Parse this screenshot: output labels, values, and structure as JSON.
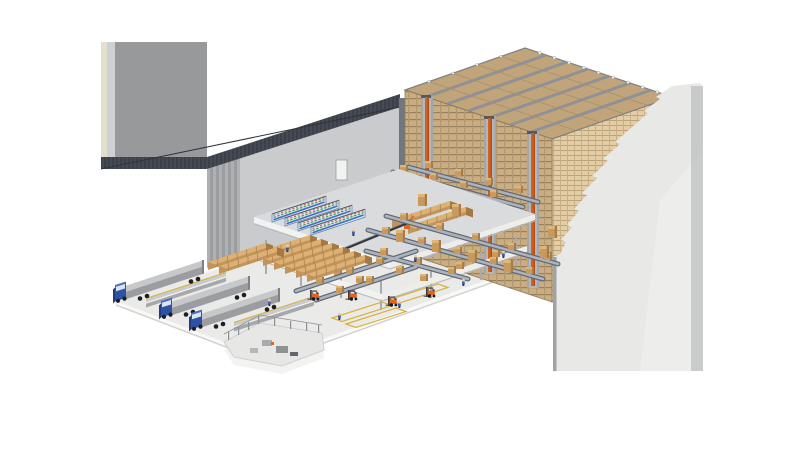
{
  "scene": {
    "description": "Isometric cutaway illustration of an automated warehouse: high-bay AS/RS pallet racking with orange stacker crane masts, multi-level picking mezzanine with bin shelving, conveyor network, floor staging lanes with palletized cardboard boxes, loading docks with trucks, and a fenced machinery enclosure",
    "projection": "isometric",
    "counts": {
      "trucks": 3,
      "stacker_crane_masts": 3,
      "rack_aisles": 3,
      "mezzanine_levels": 3,
      "shelving_units": 4,
      "forklifts": 4,
      "dock_platforms": 2,
      "workers": 8
    }
  },
  "colors": {
    "background": "#ffffff",
    "floor": "#eaeae8",
    "floor_curb": "#f8f8f6",
    "floor_shadow": "#d2d2d0",
    "building_end_wall": "#97999b",
    "building_end_wall_edge": "#e4decd",
    "building_end_wall_edge2": "#ced1d4",
    "building_fascia": "#464a52",
    "building_fascia_stripe": "#3c4048",
    "building_interior_wall": "#c9cbcd",
    "building_gable": "#aeb0b2",
    "building_gable_stripe": "#9b9da0",
    "building_corner_shadow": "#72767d",
    "cutaway_wall": "#e8e8e6",
    "cutaway_wall_edge": "#b3b5b7",
    "cutaway_wall_corner": "#a0a2a5",
    "rack_front": "#cbad84",
    "rack_front_beam": "#98815f",
    "rack_side": "#e3cda6",
    "rack_side_beam": "#bda378",
    "rack_top": "#c2a47a",
    "rack_top_frame": "#8e9196",
    "aisle_gap": "#b5b6b8",
    "crane_mast_orange": "#d2601f",
    "crane_mast_shade": "#a84b16",
    "conveyor_dark": "#5f6773",
    "conveyor_light": "#adb3bc",
    "mezzanine_slab": "#d9dbdd",
    "mezzanine_band": "#f2f2f0",
    "box_tan": "#c89a5f",
    "box_top": "#ddb679",
    "box_side": "#a87c46",
    "stack_side": "#c2945b",
    "stack_top": "#dcb173",
    "stack_end": "#a47943",
    "truck_cab_blue": "#2d51a5",
    "truck_cab_dark": "#1e3c7e",
    "truck_cab_roof": "#4a6fc0",
    "trailer_gray": "#9b9da0",
    "trailer_top": "#c6c8ca",
    "dock_gray": "#c9cbcd",
    "dock_side": "#a6a8ab",
    "marking_yellow": "#d8b23e",
    "forklift_orange": "#e06420",
    "worker_blue": "#3b5fae",
    "skin": "#eec9a3",
    "shelf_frame": "#5b80b5",
    "bin_blue": "#3f6fbe",
    "bin_green": "#49a45f",
    "bin_red": "#c5534e",
    "enclosure_wall": "#f3f3f1",
    "enclosure_floor": "#e7e7e5",
    "fence_gray": "#8c8f93",
    "machine_gray": "#a8abae"
  }
}
